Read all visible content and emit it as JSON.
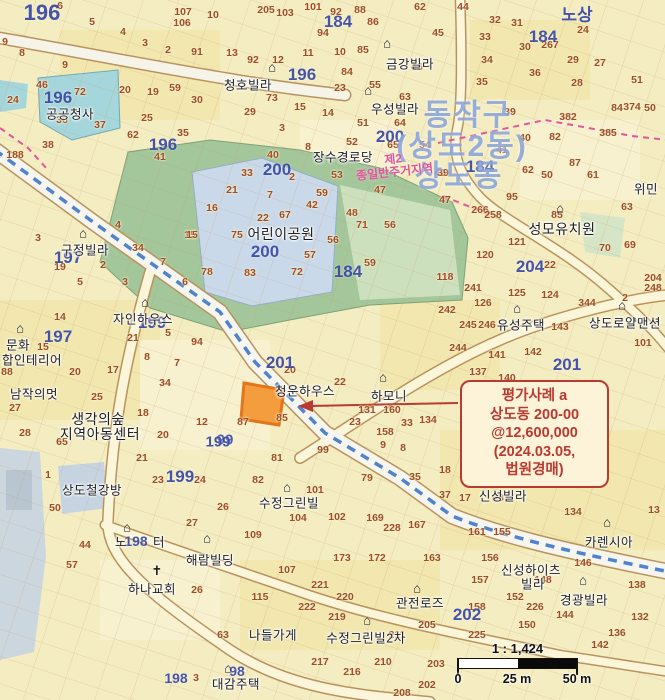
{
  "map": {
    "district_labels": [
      {
        "t": "동작구",
        "x": 468,
        "y": 112
      },
      {
        "t": "(상도2동)",
        "x": 462,
        "y": 143
      },
      {
        "t": "상도동",
        "x": 459,
        "y": 173
      }
    ],
    "zone_label": {
      "line1": "제2",
      "line2": "종일반주거지역"
    },
    "block_numbers": [
      [
        "196",
        42,
        13,
        22
      ],
      [
        "노상",
        577,
        13,
        17
      ],
      [
        "184",
        338,
        22
      ],
      [
        "184",
        543,
        37
      ],
      [
        "196",
        302,
        75
      ],
      [
        "196",
        58,
        98
      ],
      [
        "200",
        390,
        137
      ],
      [
        "196",
        163,
        145
      ],
      [
        "184",
        480,
        167
      ],
      [
        "200",
        277,
        170
      ],
      [
        "200",
        265,
        252
      ],
      [
        "197",
        68,
        258
      ],
      [
        "184",
        348,
        272
      ],
      [
        "204",
        530,
        267
      ],
      [
        "199",
        152,
        323
      ],
      [
        "197",
        58,
        337
      ],
      [
        "201",
        280,
        363
      ],
      [
        "201",
        567,
        365
      ],
      [
        "99",
        225,
        440,
        15
      ],
      [
        "199",
        218,
        442,
        15
      ],
      [
        "199",
        180,
        477
      ],
      [
        "198",
        136,
        541,
        14
      ],
      [
        "202",
        467,
        615
      ],
      [
        "98",
        237,
        671,
        14
      ],
      [
        "198",
        176,
        678,
        14
      ]
    ],
    "parcel_numbers": [
      [
        "6",
        60,
        6
      ],
      [
        "5",
        92,
        22
      ],
      [
        "4",
        123,
        32
      ],
      [
        "3",
        145,
        43
      ],
      [
        "2",
        168,
        50
      ],
      [
        "91",
        197,
        52
      ],
      [
        "107",
        183,
        12
      ],
      [
        "106",
        182,
        23
      ],
      [
        "10",
        213,
        15
      ],
      [
        "9",
        5,
        42
      ],
      [
        "8",
        22,
        53
      ],
      [
        "9",
        65,
        65
      ],
      [
        "46",
        42,
        85
      ],
      [
        "72",
        80,
        92
      ],
      [
        "20",
        125,
        90
      ],
      [
        "19",
        153,
        92
      ],
      [
        "59",
        175,
        88
      ],
      [
        "24",
        13,
        100
      ],
      [
        "30",
        197,
        100
      ],
      [
        "36",
        62,
        120
      ],
      [
        "37",
        100,
        125
      ],
      [
        "25",
        147,
        118
      ],
      [
        "62",
        133,
        135
      ],
      [
        "35",
        183,
        133
      ],
      [
        "38",
        48,
        145
      ],
      [
        "41",
        160,
        157
      ],
      [
        "188",
        15,
        155
      ],
      [
        "205",
        266,
        10
      ],
      [
        "103",
        285,
        13
      ],
      [
        "101",
        313,
        7
      ],
      [
        "92",
        336,
        12
      ],
      [
        "88",
        360,
        10
      ],
      [
        "86",
        373,
        22
      ],
      [
        "94",
        323,
        33
      ],
      [
        "62",
        420,
        7
      ],
      [
        "45",
        438,
        33
      ],
      [
        "13",
        232,
        53
      ],
      [
        "92",
        253,
        60
      ],
      [
        "12",
        278,
        60
      ],
      [
        "11",
        308,
        53
      ],
      [
        "10",
        340,
        52
      ],
      [
        "85",
        363,
        50
      ],
      [
        "46",
        417,
        67
      ],
      [
        "84",
        347,
        72
      ],
      [
        "23",
        340,
        88
      ],
      [
        "55",
        375,
        85
      ],
      [
        "73",
        272,
        98
      ],
      [
        "15",
        300,
        107
      ],
      [
        "14",
        328,
        113
      ],
      [
        "63",
        405,
        97
      ],
      [
        "29",
        250,
        112
      ],
      [
        "3",
        282,
        128
      ],
      [
        "51",
        363,
        123
      ],
      [
        "52",
        352,
        142
      ],
      [
        "64",
        400,
        123
      ],
      [
        "65",
        393,
        145
      ],
      [
        "54",
        425,
        145
      ],
      [
        "8",
        308,
        147
      ],
      [
        "40",
        273,
        155
      ],
      [
        "44",
        463,
        7
      ],
      [
        "32",
        495,
        20
      ],
      [
        "31",
        517,
        23
      ],
      [
        "33",
        485,
        37
      ],
      [
        "30",
        525,
        47
      ],
      [
        "267",
        550,
        45
      ],
      [
        "24",
        583,
        30
      ],
      [
        "29",
        573,
        60
      ],
      [
        "27",
        600,
        63
      ],
      [
        "34",
        487,
        60
      ],
      [
        "36",
        535,
        73
      ],
      [
        "28",
        577,
        83
      ],
      [
        "35",
        482,
        82
      ],
      [
        "51",
        637,
        80
      ],
      [
        "39",
        510,
        112
      ],
      [
        "382",
        568,
        117
      ],
      [
        "84",
        617,
        108
      ],
      [
        "374",
        632,
        107
      ],
      [
        "50",
        650,
        108
      ],
      [
        "40",
        525,
        138
      ],
      [
        "82",
        555,
        137
      ],
      [
        "385",
        608,
        133
      ],
      [
        "41",
        502,
        150
      ],
      [
        "33",
        247,
        173
      ],
      [
        "2",
        292,
        177
      ],
      [
        "21",
        232,
        190
      ],
      [
        "7",
        270,
        195
      ],
      [
        "16",
        212,
        208
      ],
      [
        "22",
        263,
        218
      ],
      [
        "67",
        285,
        215
      ],
      [
        "42",
        312,
        205
      ],
      [
        "59",
        322,
        193
      ],
      [
        "53",
        337,
        175
      ],
      [
        "75",
        237,
        235
      ],
      [
        "15",
        190,
        235
      ],
      [
        "78",
        207,
        272
      ],
      [
        "83",
        250,
        273
      ],
      [
        "72",
        297,
        272
      ],
      [
        "56",
        333,
        240
      ],
      [
        "57",
        310,
        255
      ],
      [
        "47",
        380,
        190
      ],
      [
        "48",
        352,
        213
      ],
      [
        "71",
        362,
        225
      ],
      [
        "56",
        390,
        225
      ],
      [
        "59",
        370,
        263
      ],
      [
        "49",
        440,
        173
      ],
      [
        "87",
        575,
        163
      ],
      [
        "62",
        528,
        170
      ],
      [
        "50",
        547,
        175
      ],
      [
        "61",
        593,
        175
      ],
      [
        "39",
        443,
        173
      ],
      [
        "95",
        512,
        197
      ],
      [
        "47",
        445,
        200
      ],
      [
        "266",
        480,
        210
      ],
      [
        "258",
        493,
        215
      ],
      [
        "63",
        627,
        207
      ],
      [
        "85",
        557,
        215
      ],
      [
        "121",
        517,
        242
      ],
      [
        "120",
        485,
        255
      ],
      [
        "22",
        550,
        265
      ],
      [
        "70",
        605,
        248
      ],
      [
        "69",
        630,
        245
      ],
      [
        "118",
        445,
        277
      ],
      [
        "241",
        473,
        288
      ],
      [
        "125",
        517,
        293
      ],
      [
        "124",
        550,
        295
      ],
      [
        "126",
        483,
        303
      ],
      [
        "344",
        587,
        303
      ],
      [
        "204",
        653,
        278
      ],
      [
        "248",
        653,
        288
      ],
      [
        "2",
        625,
        298
      ],
      [
        "245",
        468,
        325
      ],
      [
        "246",
        487,
        325
      ],
      [
        "143",
        560,
        327
      ],
      [
        "3",
        38,
        238
      ],
      [
        "19",
        60,
        267
      ],
      [
        "2",
        103,
        265
      ],
      [
        "4",
        118,
        225
      ],
      [
        "34",
        138,
        248
      ],
      [
        "15",
        192,
        235
      ],
      [
        "7",
        163,
        262
      ],
      [
        "5",
        80,
        282
      ],
      [
        "3",
        125,
        282
      ],
      [
        "6",
        185,
        282
      ],
      [
        "14",
        60,
        317
      ],
      [
        "21",
        133,
        338
      ],
      [
        "5",
        168,
        333
      ],
      [
        "8",
        147,
        357
      ],
      [
        "94",
        197,
        342
      ],
      [
        "7",
        177,
        363
      ],
      [
        "20",
        75,
        372
      ],
      [
        "17",
        113,
        370
      ],
      [
        "34",
        165,
        383
      ],
      [
        "25",
        97,
        397
      ],
      [
        "15",
        43,
        347
      ],
      [
        "88",
        7,
        372
      ],
      [
        "20",
        290,
        370
      ],
      [
        "22",
        340,
        382
      ],
      [
        "87",
        243,
        422
      ],
      [
        "85",
        282,
        418
      ],
      [
        "23",
        355,
        422
      ],
      [
        "33",
        407,
        423
      ],
      [
        "134",
        428,
        420
      ],
      [
        "81",
        277,
        458
      ],
      [
        "99",
        323,
        450
      ],
      [
        "9",
        383,
        445
      ],
      [
        "8",
        403,
        448
      ],
      [
        "158",
        385,
        432
      ],
      [
        "160",
        392,
        410
      ],
      [
        "131",
        367,
        410
      ],
      [
        "242",
        447,
        310
      ],
      [
        "244",
        458,
        348
      ],
      [
        "141",
        497,
        355
      ],
      [
        "142",
        533,
        352
      ],
      [
        "137",
        478,
        372
      ],
      [
        "140",
        507,
        378
      ],
      [
        "101",
        643,
        343
      ],
      [
        "27",
        15,
        408
      ],
      [
        "18",
        143,
        413
      ],
      [
        "20",
        163,
        435
      ],
      [
        "12",
        202,
        422
      ],
      [
        "28",
        25,
        433
      ],
      [
        "65",
        62,
        442
      ],
      [
        "21",
        142,
        458
      ],
      [
        "23",
        158,
        480
      ],
      [
        "24",
        200,
        480
      ],
      [
        "1",
        48,
        475
      ],
      [
        "50",
        55,
        508
      ],
      [
        "26",
        223,
        507
      ],
      [
        "27",
        192,
        523
      ],
      [
        "44",
        85,
        545
      ],
      [
        "57",
        72,
        565
      ],
      [
        "107",
        287,
        570
      ],
      [
        "115",
        260,
        597
      ],
      [
        "173",
        342,
        558
      ],
      [
        "172",
        377,
        558
      ],
      [
        "163",
        432,
        558
      ],
      [
        "221",
        320,
        585
      ],
      [
        "220",
        345,
        597
      ],
      [
        "222",
        307,
        607
      ],
      [
        "219",
        337,
        617
      ],
      [
        "63",
        223,
        635
      ],
      [
        "26",
        197,
        590
      ],
      [
        "211",
        397,
        635
      ],
      [
        "205",
        427,
        625
      ],
      [
        "217",
        320,
        662
      ],
      [
        "216",
        352,
        672
      ],
      [
        "210",
        383,
        662
      ],
      [
        "202",
        427,
        685
      ],
      [
        "208",
        402,
        693
      ],
      [
        "3",
        196,
        678
      ],
      [
        "37",
        445,
        495
      ],
      [
        "17",
        465,
        498
      ],
      [
        "48",
        498,
        498
      ],
      [
        "134",
        573,
        512
      ],
      [
        "161",
        477,
        532
      ],
      [
        "155",
        502,
        532
      ],
      [
        "156",
        490,
        558
      ],
      [
        "146",
        583,
        563
      ],
      [
        "148",
        543,
        580
      ],
      [
        "157",
        480,
        580
      ],
      [
        "138",
        637,
        585
      ],
      [
        "152",
        515,
        597
      ],
      [
        "226",
        535,
        607
      ],
      [
        "144",
        565,
        615
      ],
      [
        "158",
        477,
        607
      ],
      [
        "150",
        527,
        625
      ],
      [
        "132",
        640,
        617
      ],
      [
        "136",
        617,
        633
      ],
      [
        "225",
        477,
        635
      ],
      [
        "13",
        654,
        510
      ],
      [
        "82",
        258,
        480
      ],
      [
        "79",
        367,
        478
      ],
      [
        "35",
        415,
        477
      ],
      [
        "18",
        445,
        470
      ],
      [
        "101",
        315,
        490
      ],
      [
        "104",
        298,
        518
      ],
      [
        "102",
        337,
        517
      ],
      [
        "169",
        375,
        518
      ],
      [
        "228",
        392,
        528
      ],
      [
        "167",
        417,
        525
      ],
      [
        "109",
        253,
        535
      ],
      [
        "142",
        600,
        645
      ],
      [
        "203",
        436,
        664
      ]
    ],
    "place_labels": [
      [
        "청호빌라",
        248,
        84
      ],
      [
        "금강빌라",
        410,
        63
      ],
      [
        "우성빌라",
        395,
        108
      ],
      [
        "장수경로당",
        343,
        156
      ],
      [
        "공공청사",
        70,
        113
      ],
      [
        "어린이공원",
        281,
        234,
        14
      ],
      [
        "성모유치원",
        562,
        229,
        14
      ],
      [
        "위민",
        646,
        188
      ],
      [
        "구정빌라",
        85,
        249
      ],
      [
        "자인하우스",
        143,
        318
      ],
      [
        "문화",
        18,
        344
      ],
      [
        "합인테리어",
        32,
        359
      ],
      [
        "남작의멋",
        34,
        393
      ],
      [
        "생각의숲",
        98,
        419,
        14
      ],
      [
        "지역아동센터",
        100,
        434,
        14
      ],
      [
        "상도철강방",
        92,
        489
      ],
      [
        "청운하우스",
        305,
        390
      ],
      [
        "하모니",
        389,
        395
      ],
      [
        "유성주택",
        521,
        324
      ],
      [
        "상도로얄맨션",
        625,
        322
      ],
      [
        "신성빌라",
        503,
        495
      ],
      [
        "카렌시아",
        609,
        541
      ],
      [
        "신성하이츠",
        531,
        569
      ],
      [
        "빌라",
        533,
        583
      ],
      [
        "경광빌라",
        584,
        599
      ],
      [
        "수정그린빌",
        289,
        502
      ],
      [
        "해람빌딩",
        210,
        559
      ],
      [
        "하나교회",
        152,
        588
      ],
      [
        "노",
        121,
        541
      ],
      [
        "터",
        159,
        541
      ],
      [
        "대감주택",
        236,
        683
      ],
      [
        "나들가게",
        273,
        634
      ],
      [
        "수정그린빌2차",
        366,
        637
      ],
      [
        "관전로즈",
        420,
        602
      ]
    ],
    "icons": [
      [
        "h",
        387,
        43
      ],
      [
        "h",
        272,
        67
      ],
      [
        "h",
        368,
        90
      ],
      [
        "h",
        83,
        233
      ],
      [
        "h",
        145,
        302
      ],
      [
        "h",
        20,
        328
      ],
      [
        "h",
        560,
        208
      ],
      [
        "h",
        517,
        308
      ],
      [
        "h",
        622,
        305
      ],
      [
        "h",
        383,
        377
      ],
      [
        "h",
        127,
        527
      ],
      [
        "h",
        207,
        538
      ],
      [
        "h",
        287,
        487
      ],
      [
        "h",
        367,
        620
      ],
      [
        "h",
        417,
        588
      ],
      [
        "h",
        607,
        522
      ],
      [
        "h",
        583,
        580
      ],
      [
        "h",
        228,
        668
      ],
      [
        "c",
        157,
        571
      ]
    ],
    "icon_glyphs": {
      "h": "⌂",
      "c": "✝"
    }
  },
  "callout": {
    "lines": [
      "평가사례 a",
      "상도동 200-00",
      "@12,600,000",
      "(2024.03.05,",
      "법원경매)"
    ]
  },
  "scalebar": {
    "ratio": "1 : 1,424",
    "labels": [
      "0",
      "25 m",
      "50 m"
    ]
  },
  "colors": {
    "base": "#f4edc2",
    "park_green": "#a3c69b",
    "park_cells_blue": "#c9d9ea",
    "public_cyan": "#a5d6dc",
    "highlight_orange": "#f49d3e",
    "callout_red": "#b93a30",
    "stream_blue": "#4f83cc",
    "block_blue": "#2d3e9e",
    "parcel_brown": "#9e4d2a",
    "zone_magenta": "#e0559c"
  }
}
